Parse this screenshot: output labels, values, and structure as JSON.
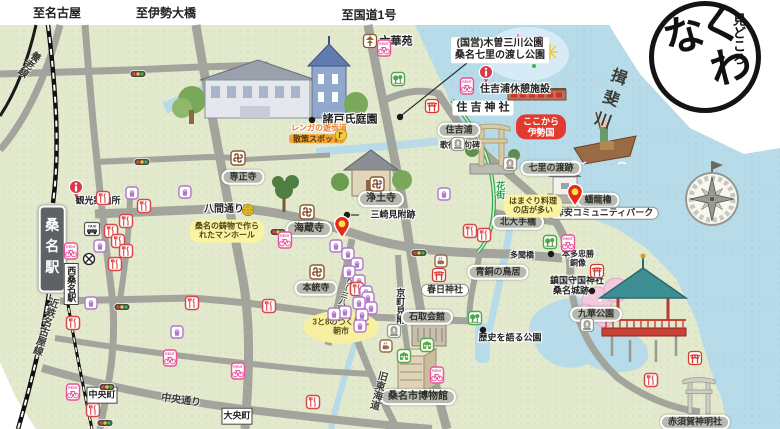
{
  "map": {
    "logo": {
      "sub": "見どころ",
      "main": "くわな"
    },
    "labels": [
      {
        "name": "to-nagoya",
        "text": "至名古屋",
        "x": 57,
        "y": 13,
        "cls": "plain fs12"
      },
      {
        "name": "to-ise-ohashi",
        "text": "至伊勢大橋",
        "x": 166,
        "y": 13,
        "cls": "plain fs12"
      },
      {
        "name": "to-route1",
        "text": "至国道1号",
        "x": 369,
        "y": 15,
        "cls": "plain fs12"
      },
      {
        "name": "rokkaen",
        "text": "六華苑",
        "x": 396,
        "y": 42,
        "cls": "plain fs11"
      },
      {
        "name": "kiso-sansen-park",
        "lines": [
          "(国営)木曽三川公園",
          "桑名七里の渡し公園"
        ],
        "x": 500,
        "y": 50,
        "cls": "plain-box fs10"
      },
      {
        "name": "sumiyoshiura-rest-facility",
        "text": "住吉浦休憩施設",
        "x": 515,
        "y": 90,
        "cls": "plain fs10"
      },
      {
        "name": "sumiyoshi-shrine",
        "text": "住 吉 神 社",
        "x": 483,
        "y": 108,
        "cls": "plain-box fs11"
      },
      {
        "name": "sumiyoshiura",
        "text": "住吉浦",
        "x": 459,
        "y": 130,
        "cls": "pill-gray fs9"
      },
      {
        "name": "utaandon-kuhi",
        "text": "歌行灯句碑",
        "x": 460,
        "y": 145,
        "cls": "plain fs8"
      },
      {
        "name": "kokokara-isenokuni",
        "lines": [
          "ここから",
          "伊勢国"
        ],
        "x": 541,
        "y": 127,
        "cls": "bubble-red fs9"
      },
      {
        "name": "shichiri-no-watashi-site",
        "text": "七里の渡跡",
        "x": 551,
        "y": 168,
        "cls": "pill-gray fs9"
      },
      {
        "name": "ibi-river",
        "text": "揖斐川",
        "x": 607,
        "y": 100,
        "cls": "river-text fs16 vert",
        "rot": 20
      },
      {
        "name": "banryu-yagura",
        "text": "蟠龍櫓",
        "x": 598,
        "y": 200,
        "cls": "pill-gray fs9"
      },
      {
        "name": "kakiyasu-community-park",
        "text": "柿安コミュニティパーク",
        "x": 604,
        "y": 213,
        "cls": "pill-white fs9"
      },
      {
        "name": "moroto-garden",
        "text": "諸戸氏庭園",
        "x": 350,
        "y": 120,
        "cls": "plain fs11"
      },
      {
        "name": "renga-promenade",
        "text": "レンガの遊歩道",
        "x": 319,
        "y": 128,
        "cls": "orange-text fs8"
      },
      {
        "name": "sansaku-spot",
        "text": "散策スポット",
        "x": 317,
        "y": 139,
        "cls": "orange-box fs8"
      },
      {
        "name": "senshoji",
        "text": "専正寺",
        "x": 243,
        "y": 177,
        "cls": "pill-gray fs9"
      },
      {
        "name": "jodoji",
        "text": "浄土寺",
        "x": 381,
        "y": 199,
        "cls": "pill-gray fs10"
      },
      {
        "name": "misaki-mitsuke-site",
        "text": "三崎見附跡",
        "x": 393,
        "y": 215,
        "cls": "plain fs9"
      },
      {
        "name": "kaizoji",
        "text": "海蔵寺",
        "x": 309,
        "y": 229,
        "cls": "pill-gray fs10"
      },
      {
        "name": "tourist-information",
        "text": "観光案内所",
        "x": 98,
        "y": 201,
        "cls": "plain fs9"
      },
      {
        "name": "hachiken-dori",
        "text": "八間通り",
        "x": 224,
        "y": 210,
        "cls": "plain fs10"
      },
      {
        "name": "manhole-note",
        "lines": [
          "桑名の鋳物で作ら",
          "れたマンホール"
        ],
        "x": 227,
        "y": 231,
        "cls": "bubble-yellow fs8"
      },
      {
        "name": "kuwana-station",
        "text": "桑名駅",
        "x": 52,
        "y": 249,
        "cls": "station fs14 vert"
      },
      {
        "name": "nishi-kuwana-station",
        "text": "西桑名駅",
        "x": 71,
        "y": 284,
        "cls": "whitebox fs9 vert"
      },
      {
        "name": "hontoji",
        "text": "本統寺",
        "x": 316,
        "y": 288,
        "cls": "pill-gray fs9"
      },
      {
        "name": "morning-market-note",
        "lines": [
          "3と8のつく日に",
          "朝市"
        ],
        "x": 341,
        "y": 327,
        "cls": "ellipse-yellow fs8"
      },
      {
        "name": "teramachi-dori",
        "text": "寺町通り(三八市)",
        "x": 346,
        "y": 288,
        "cls": "road-text fs7 vert",
        "rot": 18
      },
      {
        "name": "kyomachi-mitsuke",
        "text": "京町見附",
        "x": 400,
        "y": 306,
        "cls": "plain fs9 vert"
      },
      {
        "name": "ishidori-kaikan",
        "text": "石取会館",
        "x": 427,
        "y": 317,
        "cls": "pill-gray fs9"
      },
      {
        "name": "kasuga-shrine",
        "text": "春日神社",
        "x": 445,
        "y": 290,
        "cls": "pill-white fs9"
      },
      {
        "name": "bronze-torii",
        "text": "青銅の鳥居",
        "x": 498,
        "y": 272,
        "cls": "pill-gray fs9"
      },
      {
        "name": "tamon-bridge",
        "text": "多聞橋",
        "x": 522,
        "y": 255,
        "cls": "plain fs8"
      },
      {
        "name": "kita-ote-bridge",
        "text": "北大手橋",
        "x": 518,
        "y": 222,
        "cls": "pill-gray fs9"
      },
      {
        "name": "honda-tadakatsu-statue",
        "lines": [
          "本多忠勝",
          "銅像"
        ],
        "x": 578,
        "y": 259,
        "cls": "plain fs8"
      },
      {
        "name": "chinkoku-shukoku-shrine",
        "text": "鎮国守国神社",
        "x": 577,
        "y": 281,
        "cls": "plain fs9"
      },
      {
        "name": "kuwana-castle-site",
        "text": "桑名城跡",
        "x": 571,
        "y": 291,
        "cls": "plain fs9"
      },
      {
        "name": "kyuka-park",
        "text": "九華公園",
        "x": 596,
        "y": 314,
        "cls": "pill-gray fs9"
      },
      {
        "name": "history-park",
        "text": "歴史を語る公園",
        "x": 510,
        "y": 338,
        "cls": "plain fs9"
      },
      {
        "name": "kuwana-city-museum",
        "text": "桑名市博物館",
        "x": 418,
        "y": 397,
        "cls": "pill-gray fs10"
      },
      {
        "name": "kyu-tokaido",
        "text": "旧東海道",
        "x": 377,
        "y": 390,
        "cls": "road-text fs10 vert",
        "rot": 15
      },
      {
        "name": "akasuka-shinmeisha",
        "text": "赤須賀神明社",
        "x": 695,
        "y": 422,
        "cls": "pill-gray fs9"
      },
      {
        "name": "daio-cho",
        "text": "大央町",
        "x": 237,
        "y": 416,
        "cls": "whitebox fs9"
      },
      {
        "name": "chuo-cho",
        "text": "中央町",
        "x": 102,
        "y": 395,
        "cls": "whitebox fs9"
      },
      {
        "name": "chuo-dori",
        "text": "中央通り",
        "x": 181,
        "y": 401,
        "cls": "road-text fs10",
        "rot": 8
      },
      {
        "name": "kintetsu-nagoya-line",
        "text": "近鉄名古屋線",
        "x": 44,
        "y": 326,
        "cls": "road-text fs10 vert",
        "rot": 18
      },
      {
        "name": "yoro-line",
        "text": "養老線",
        "x": 28,
        "y": 63,
        "cls": "road-text fs10 vert",
        "rot": 38
      },
      {
        "name": "hanamachi",
        "text": "花街",
        "x": 500,
        "y": 190,
        "cls": "green-text fs9 vert"
      },
      {
        "name": "hamaguri-note",
        "lines": [
          "はまぐり料理",
          "の店が多い"
        ],
        "x": 533,
        "y": 206,
        "cls": "bubble-yellow fs8"
      }
    ],
    "icons": [
      {
        "t": "pagoda",
        "x": 370,
        "y": 41
      },
      {
        "t": "bike",
        "x": 384,
        "y": 48
      },
      {
        "t": "park",
        "x": 398,
        "y": 79
      },
      {
        "t": "info",
        "x": 486,
        "y": 74
      },
      {
        "t": "bike",
        "x": 467,
        "y": 86
      },
      {
        "t": "shrine",
        "x": 432,
        "y": 106
      },
      {
        "t": "monument",
        "x": 458,
        "y": 144
      },
      {
        "t": "monument",
        "x": 510,
        "y": 164
      },
      {
        "t": "dot",
        "x": 312,
        "y": 120
      },
      {
        "t": "dot",
        "x": 400,
        "y": 117
      },
      {
        "t": "flag",
        "x": 341,
        "y": 137
      },
      {
        "t": "temple",
        "x": 238,
        "y": 158
      },
      {
        "t": "temple",
        "x": 377,
        "y": 184
      },
      {
        "t": "temple",
        "x": 307,
        "y": 212
      },
      {
        "t": "temple",
        "x": 317,
        "y": 272
      },
      {
        "t": "dot",
        "x": 347,
        "y": 215
      },
      {
        "t": "info",
        "x": 76,
        "y": 189
      },
      {
        "t": "taxi",
        "x": 92,
        "y": 229
      },
      {
        "t": "bike",
        "x": 71,
        "y": 251
      },
      {
        "t": "cross",
        "x": 89,
        "y": 259
      },
      {
        "t": "manhole",
        "x": 248,
        "y": 210
      },
      {
        "t": "traffic",
        "x": 138,
        "y": 74
      },
      {
        "t": "traffic",
        "x": 142,
        "y": 162
      },
      {
        "t": "traffic",
        "x": 278,
        "y": 232
      },
      {
        "t": "traffic",
        "x": 419,
        "y": 253
      },
      {
        "t": "traffic",
        "x": 122,
        "y": 307
      },
      {
        "t": "traffic",
        "x": 107,
        "y": 387
      },
      {
        "t": "traffic",
        "x": 105,
        "y": 423
      },
      {
        "t": "pin",
        "x": 342,
        "y": 227
      },
      {
        "t": "pin",
        "x": 575,
        "y": 195
      },
      {
        "t": "bike",
        "x": 285,
        "y": 240
      },
      {
        "t": "rest",
        "x": 103,
        "y": 198
      },
      {
        "t": "rest",
        "x": 144,
        "y": 206
      },
      {
        "t": "rest",
        "x": 126,
        "y": 221
      },
      {
        "t": "rest",
        "x": 111,
        "y": 231
      },
      {
        "t": "rest",
        "x": 118,
        "y": 241
      },
      {
        "t": "rest",
        "x": 126,
        "y": 251
      },
      {
        "t": "rest",
        "x": 115,
        "y": 264
      },
      {
        "t": "shop",
        "x": 132,
        "y": 193
      },
      {
        "t": "shop",
        "x": 185,
        "y": 192
      },
      {
        "t": "shop",
        "x": 100,
        "y": 246
      },
      {
        "t": "shop",
        "x": 444,
        "y": 194
      },
      {
        "t": "rest",
        "x": 470,
        "y": 231
      },
      {
        "t": "rest",
        "x": 484,
        "y": 235
      },
      {
        "t": "cafe",
        "x": 441,
        "y": 261
      },
      {
        "t": "shrine",
        "x": 439,
        "y": 275
      },
      {
        "t": "shrine",
        "x": 597,
        "y": 271
      },
      {
        "t": "shrine",
        "x": 695,
        "y": 358
      },
      {
        "t": "dot",
        "x": 551,
        "y": 254
      },
      {
        "t": "dot",
        "x": 592,
        "y": 291
      },
      {
        "t": "dot",
        "x": 483,
        "y": 330
      },
      {
        "t": "bike",
        "x": 568,
        "y": 243
      },
      {
        "t": "park",
        "x": 550,
        "y": 242
      },
      {
        "t": "park",
        "x": 475,
        "y": 318
      },
      {
        "t": "monument",
        "x": 587,
        "y": 325
      },
      {
        "t": "monument",
        "x": 394,
        "y": 331
      },
      {
        "t": "cafe",
        "x": 386,
        "y": 346
      },
      {
        "t": "bldg",
        "x": 427,
        "y": 345
      },
      {
        "t": "bldg",
        "x": 404,
        "y": 356
      },
      {
        "t": "bike",
        "x": 437,
        "y": 375
      },
      {
        "t": "rest",
        "x": 269,
        "y": 306
      },
      {
        "t": "rest",
        "x": 192,
        "y": 303
      },
      {
        "t": "rest",
        "x": 73,
        "y": 323
      },
      {
        "t": "rest",
        "x": 313,
        "y": 402
      },
      {
        "t": "rest",
        "x": 93,
        "y": 410
      },
      {
        "t": "rest",
        "x": 651,
        "y": 380
      },
      {
        "t": "shop",
        "x": 91,
        "y": 303
      },
      {
        "t": "shop",
        "x": 177,
        "y": 332
      },
      {
        "t": "bike",
        "x": 73,
        "y": 392
      },
      {
        "t": "bike",
        "x": 170,
        "y": 358
      },
      {
        "t": "bike",
        "x": 238,
        "y": 371
      },
      {
        "t": "shop",
        "x": 336,
        "y": 246
      },
      {
        "t": "shop",
        "x": 348,
        "y": 254
      },
      {
        "t": "shop",
        "x": 357,
        "y": 264
      },
      {
        "t": "shop",
        "x": 349,
        "y": 272
      },
      {
        "t": "shop",
        "x": 359,
        "y": 281
      },
      {
        "t": "rest",
        "x": 357,
        "y": 289
      },
      {
        "t": "shop",
        "x": 366,
        "y": 292
      },
      {
        "t": "shop",
        "x": 368,
        "y": 298
      },
      {
        "t": "shop",
        "x": 359,
        "y": 303
      },
      {
        "t": "shop",
        "x": 371,
        "y": 308
      },
      {
        "t": "shop",
        "x": 362,
        "y": 315
      },
      {
        "t": "shop",
        "x": 345,
        "y": 312
      },
      {
        "t": "shop",
        "x": 334,
        "y": 314
      },
      {
        "t": "shop",
        "x": 360,
        "y": 326
      }
    ]
  }
}
